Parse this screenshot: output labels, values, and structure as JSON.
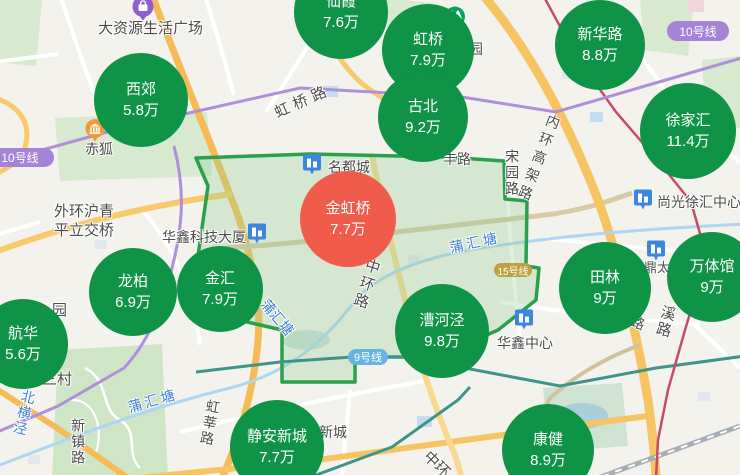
{
  "colors": {
    "bubble_green": "#0f9347",
    "bubble_red": "#f15b4b",
    "line10_badge": "#a583d6",
    "line15_badge": "#bfa13f",
    "line9_badge": "#66b3e3",
    "water_text": "#3f7fd6",
    "road_text": "#4c4c4c",
    "district_outline": "#2aa04c"
  },
  "bubbles": [
    {
      "name": "仙霞",
      "price": "7.6万",
      "x": 341,
      "y": 12,
      "r": 47,
      "color": "green"
    },
    {
      "name": "虹桥",
      "price": "7.9万",
      "x": 428,
      "y": 50,
      "r": 46,
      "color": "green"
    },
    {
      "name": "古北",
      "price": "9.2万",
      "x": 423,
      "y": 117,
      "r": 45,
      "color": "green"
    },
    {
      "name": "新华路",
      "price": "8.8万",
      "x": 600,
      "y": 45,
      "r": 45,
      "color": "green"
    },
    {
      "name": "徐家汇",
      "price": "11.4万",
      "x": 688,
      "y": 131,
      "r": 48,
      "color": "green"
    },
    {
      "name": "西郊",
      "price": "5.8万",
      "x": 141,
      "y": 100,
      "r": 47,
      "color": "green"
    },
    {
      "name": "金虹桥",
      "price": "7.7万",
      "x": 348,
      "y": 219,
      "r": 48,
      "color": "red"
    },
    {
      "name": "龙柏",
      "price": "6.9万",
      "x": 133,
      "y": 292,
      "r": 44,
      "color": "green"
    },
    {
      "name": "金汇",
      "price": "7.9万",
      "x": 220,
      "y": 289,
      "r": 43,
      "color": "green"
    },
    {
      "name": "航华",
      "price": "5.6万",
      "x": 23,
      "y": 344,
      "r": 45,
      "color": "green"
    },
    {
      "name": "田林",
      "price": "9万",
      "x": 605,
      "y": 288,
      "r": 46,
      "color": "green"
    },
    {
      "name": "万体馆",
      "price": "9万",
      "x": 712,
      "y": 277,
      "r": 45,
      "color": "green"
    },
    {
      "name": "漕河泾",
      "price": "9.8万",
      "x": 442,
      "y": 331,
      "r": 47,
      "color": "green"
    },
    {
      "name": "静安新城",
      "price": "7.7万",
      "x": 277,
      "y": 447,
      "r": 47,
      "color": "green"
    },
    {
      "name": "康健",
      "price": "8.9万",
      "x": 548,
      "y": 450,
      "r": 46,
      "color": "green"
    }
  ],
  "metro_badges": [
    {
      "text": "10号线",
      "x": -14,
      "y": 148,
      "w": 68,
      "h": 19,
      "type": "line10"
    },
    {
      "text": "10号线",
      "x": 667,
      "y": 21,
      "w": 62,
      "h": 20,
      "type": "line10"
    },
    {
      "text": "15号线",
      "x": 494,
      "y": 263,
      "w": 38,
      "h": 14,
      "type": "line15"
    },
    {
      "text": "9号线",
      "x": 348,
      "y": 349,
      "w": 40,
      "h": 16,
      "type": "line9"
    }
  ],
  "poi_icons": [
    {
      "type": "mall",
      "x": 143,
      "y": 10
    },
    {
      "type": "bank",
      "x": 95,
      "y": 132
    },
    {
      "type": "metro",
      "x": 455,
      "y": 17
    },
    {
      "type": "building",
      "x": 312,
      "y": 166
    },
    {
      "type": "building",
      "x": 257,
      "y": 235
    },
    {
      "type": "building",
      "x": 643,
      "y": 201
    },
    {
      "type": "building",
      "x": 524,
      "y": 321
    },
    {
      "type": "building",
      "x": 656,
      "y": 252
    }
  ],
  "map_labels": [
    {
      "text": "大资源生活广场",
      "x": 98,
      "y": 20,
      "s": 15
    },
    {
      "text": "赤狐",
      "x": 85,
      "y": 141,
      "s": 14
    },
    {
      "text": "外环沪青",
      "x": 54,
      "y": 203,
      "s": 15
    },
    {
      "text": "平立交桥",
      "x": 54,
      "y": 222,
      "s": 15
    },
    {
      "text": "华鑫科技大厦",
      "x": 162,
      "y": 229,
      "s": 14
    },
    {
      "text": "名都城",
      "x": 328,
      "y": 159,
      "s": 14
    },
    {
      "text": "虹桥路",
      "x": 272,
      "y": 106,
      "s": 15,
      "rot": -24,
      "ls": 5
    },
    {
      "text": "丰路",
      "x": 443,
      "y": 151,
      "s": 14
    },
    {
      "text": "宋园路",
      "x": 504,
      "y": 149,
      "s": 14,
      "vert": true
    },
    {
      "text": "内环高架路",
      "x": 548,
      "y": 112,
      "s": 14,
      "vert": true,
      "rot": 21,
      "ls": 5
    },
    {
      "text": "尚光徐汇中心",
      "x": 657,
      "y": 194,
      "s": 14
    },
    {
      "text": "鼎太",
      "x": 644,
      "y": 261,
      "s": 13
    },
    {
      "text": "中环路",
      "x": 366,
      "y": 256,
      "s": 15,
      "vert": true,
      "rot": 18,
      "ls": 3
    },
    {
      "text": "蒲汇塘",
      "x": 448,
      "y": 240,
      "s": 14,
      "blue": true,
      "rot": -12,
      "ls": 3
    },
    {
      "text": "蒲汇塘",
      "x": 270,
      "y": 296,
      "s": 14,
      "blue": true,
      "rot": 50
    },
    {
      "text": "蒲汇塘",
      "x": 126,
      "y": 400,
      "s": 14,
      "blue": true,
      "rot": -16,
      "ls": 3
    },
    {
      "text": "园",
      "x": 52,
      "y": 302,
      "s": 15
    },
    {
      "text": "园",
      "x": 469,
      "y": 41,
      "s": 14
    },
    {
      "text": "三村",
      "x": 42,
      "y": 371,
      "s": 15
    },
    {
      "text": "北横泾",
      "x": 22,
      "y": 388,
      "s": 14,
      "blue": true,
      "vert": true,
      "rot": 14
    },
    {
      "text": "新镇路",
      "x": 70,
      "y": 418,
      "s": 14,
      "vert": true
    },
    {
      "text": "虹莘路",
      "x": 206,
      "y": 398,
      "s": 14,
      "vert": true,
      "rot": 10
    },
    {
      "text": "安新城",
      "x": 305,
      "y": 424,
      "s": 14
    },
    {
      "text": "中环",
      "x": 432,
      "y": 448,
      "s": 15,
      "rot": 45
    },
    {
      "text": "华鑫中心",
      "x": 497,
      "y": 335,
      "s": 14
    },
    {
      "text": "溪路",
      "x": 661,
      "y": 303,
      "s": 15,
      "vert": true,
      "rot": 15
    },
    {
      "text": "路",
      "x": 634,
      "y": 313,
      "s": 14,
      "rot": 20
    }
  ]
}
